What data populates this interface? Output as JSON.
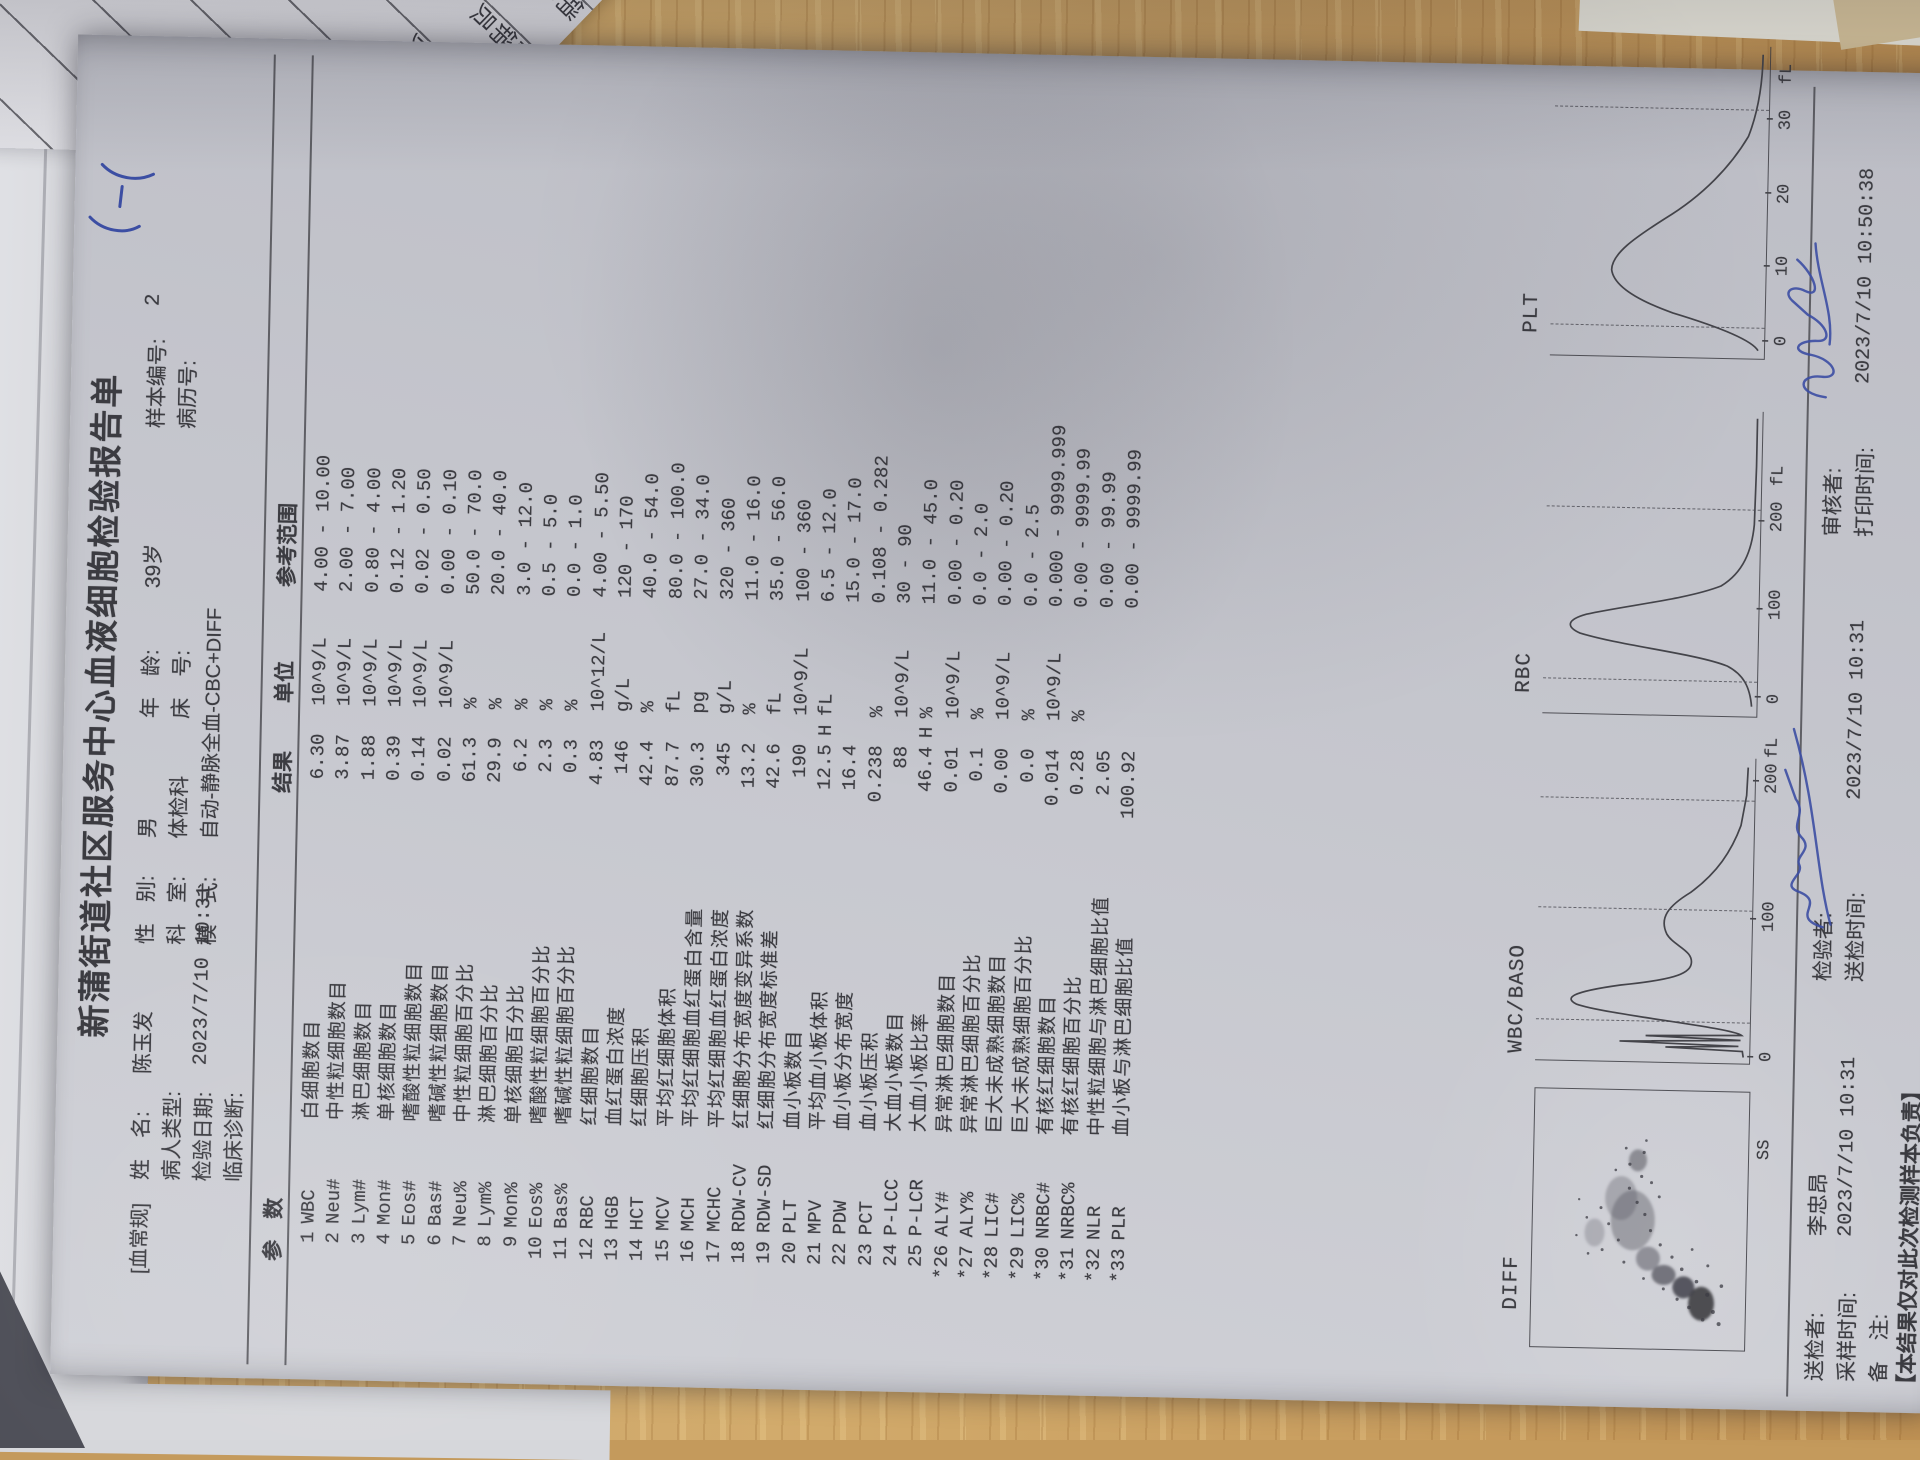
{
  "desk_papers": {
    "cells": [
      "日化促",
      "日化促销",
      "化促销员",
      "促销员",
      "销员",
      "员"
    ],
    "names": [
      "余",
      "张华",
      "鲁景玉"
    ]
  },
  "report": {
    "title": "新蒲街道社区服务中心血液细胞检验报告单",
    "category_tag": "[血常规]",
    "handwritten_mark": "5-5",
    "header": {
      "name_label": "姓　名:",
      "name_value": "陈玉发",
      "sex_label": "性　别:",
      "sex_value": "男",
      "age_label": "年　龄:",
      "age_value": "39岁",
      "sample_no_label": "样本编号:",
      "sample_no_value": "2",
      "patient_type_label": "病人类型:",
      "patient_type_value": "",
      "dept_label": "科　室:",
      "dept_value": "体检科",
      "bed_label": "床　号:",
      "bed_value": "",
      "case_no_label": "病历号:",
      "case_no_value": "",
      "test_date_label": "检验日期:",
      "test_date_value": "2023/7/10  10:31",
      "mode_label": "模　式:",
      "mode_value": "自动-静脉全血-CBC+DIFF",
      "diagnosis_label": "临床诊断:",
      "diagnosis_value": ""
    },
    "table": {
      "headers": {
        "param": "参　数",
        "result": "结果",
        "unit": "单位",
        "range": "参考范围"
      },
      "rows": [
        {
          "num": "1",
          "code": "WBC",
          "name": "白细胞数目",
          "result": "6.30",
          "flag": "",
          "unit": "10^9/L",
          "range": "4.00 - 10.00"
        },
        {
          "num": "2",
          "code": "Neu#",
          "name": "中性粒细胞数目",
          "result": "3.87",
          "flag": "",
          "unit": "10^9/L",
          "range": "2.00 - 7.00"
        },
        {
          "num": "3",
          "code": "Lym#",
          "name": "淋巴细胞数目",
          "result": "1.88",
          "flag": "",
          "unit": "10^9/L",
          "range": "0.80 - 4.00"
        },
        {
          "num": "4",
          "code": "Mon#",
          "name": "单核细胞数目",
          "result": "0.39",
          "flag": "",
          "unit": "10^9/L",
          "range": "0.12 - 1.20"
        },
        {
          "num": "5",
          "code": "Eos#",
          "name": "嗜酸性粒细胞数目",
          "result": "0.14",
          "flag": "",
          "unit": "10^9/L",
          "range": "0.02 - 0.50"
        },
        {
          "num": "6",
          "code": "Bas#",
          "name": "嗜碱性粒细胞数目",
          "result": "0.02",
          "flag": "",
          "unit": "10^9/L",
          "range": "0.00 - 0.10"
        },
        {
          "num": "7",
          "code": "Neu%",
          "name": "中性粒细胞百分比",
          "result": "61.3",
          "flag": "",
          "unit": "%",
          "range": "50.0 - 70.0"
        },
        {
          "num": "8",
          "code": "Lym%",
          "name": "淋巴细胞百分比",
          "result": "29.9",
          "flag": "",
          "unit": "%",
          "range": "20.0 - 40.0"
        },
        {
          "num": "9",
          "code": "Mon%",
          "name": "单核细胞百分比",
          "result": "6.2",
          "flag": "",
          "unit": "%",
          "range": "3.0 - 12.0"
        },
        {
          "num": "10",
          "code": "Eos%",
          "name": "嗜酸性粒细胞百分比",
          "result": "2.3",
          "flag": "",
          "unit": "%",
          "range": "0.5 - 5.0"
        },
        {
          "num": "11",
          "code": "Bas%",
          "name": "嗜碱性粒细胞百分比",
          "result": "0.3",
          "flag": "",
          "unit": "%",
          "range": "0.0 - 1.0"
        },
        {
          "num": "12",
          "code": "RBC",
          "name": "红细胞数目",
          "result": "4.83",
          "flag": "",
          "unit": "10^12/L",
          "range": "4.00 - 5.50"
        },
        {
          "num": "13",
          "code": "HGB",
          "name": "血红蛋白浓度",
          "result": "146",
          "flag": "",
          "unit": "g/L",
          "range": "120 - 170"
        },
        {
          "num": "14",
          "code": "HCT",
          "name": "红细胞压积",
          "result": "42.4",
          "flag": "",
          "unit": "%",
          "range": "40.0 - 54.0"
        },
        {
          "num": "15",
          "code": "MCV",
          "name": "平均红细胞体积",
          "result": "87.7",
          "flag": "",
          "unit": "fL",
          "range": "80.0 - 100.0"
        },
        {
          "num": "16",
          "code": "MCH",
          "name": "平均红细胞血红蛋白含量",
          "result": "30.3",
          "flag": "",
          "unit": "pg",
          "range": "27.0 - 34.0"
        },
        {
          "num": "17",
          "code": "MCHC",
          "name": "平均红细胞血红蛋白浓度",
          "result": "345",
          "flag": "",
          "unit": "g/L",
          "range": "320 - 360"
        },
        {
          "num": "18",
          "code": "RDW-CV",
          "name": "红细胞分布宽度变异系数",
          "result": "13.2",
          "flag": "",
          "unit": "%",
          "range": "11.0 - 16.0"
        },
        {
          "num": "19",
          "code": "RDW-SD",
          "name": "红细胞分布宽度标准差",
          "result": "42.6",
          "flag": "",
          "unit": "fL",
          "range": "35.0 - 56.0"
        },
        {
          "num": "20",
          "code": "PLT",
          "name": "血小板数目",
          "result": "190",
          "flag": "",
          "unit": "10^9/L",
          "range": "100 - 360"
        },
        {
          "num": "21",
          "code": "MPV",
          "name": "平均血小板体积",
          "result": "12.5",
          "flag": "H",
          "unit": "fL",
          "range": "6.5 - 12.0"
        },
        {
          "num": "22",
          "code": "PDW",
          "name": "血小板分布宽度",
          "result": "16.4",
          "flag": "",
          "unit": "",
          "range": "15.0 - 17.0"
        },
        {
          "num": "23",
          "code": "PCT",
          "name": "血小板压积",
          "result": "0.238",
          "flag": "",
          "unit": "%",
          "range": "0.108 - 0.282"
        },
        {
          "num": "24",
          "code": "P-LCC",
          "name": "大血小板数目",
          "result": "88",
          "flag": "",
          "unit": "10^9/L",
          "range": "30 - 90"
        },
        {
          "num": "25",
          "code": "P-LCR",
          "name": "大血小板比率",
          "result": "46.4",
          "flag": "H",
          "unit": "%",
          "range": "11.0 - 45.0"
        },
        {
          "num": "*26",
          "code": "ALY#",
          "name": "异常淋巴细胞数目",
          "result": "0.01",
          "flag": "",
          "unit": "10^9/L",
          "range": "0.00 - 0.20"
        },
        {
          "num": "*27",
          "code": "ALY%",
          "name": "异常淋巴细胞百分比",
          "result": "0.1",
          "flag": "",
          "unit": "%",
          "range": "0.0 - 2.0"
        },
        {
          "num": "*28",
          "code": "LIC#",
          "name": "巨大未成熟细胞数目",
          "result": "0.00",
          "flag": "",
          "unit": "10^9/L",
          "range": "0.00 - 0.20"
        },
        {
          "num": "*29",
          "code": "LIC%",
          "name": "巨大未成熟细胞百分比",
          "result": "0.0",
          "flag": "",
          "unit": "%",
          "range": "0.0 - 2.5"
        },
        {
          "num": "*30",
          "code": "NRBC#",
          "name": "有核红细胞数目",
          "result": "0.014",
          "flag": "",
          "unit": "10^9/L",
          "range": "0.000 - 9999.999"
        },
        {
          "num": "*31",
          "code": "NRBC%",
          "name": "有核红细胞百分比",
          "result": "0.28",
          "flag": "",
          "unit": "%",
          "range": "0.00 - 9999.99"
        },
        {
          "num": "*32",
          "code": "NLR",
          "name": "中性粒细胞与淋巴细胞比值",
          "result": "2.05",
          "flag": "",
          "unit": "",
          "range": "0.00 - 99.99"
        },
        {
          "num": "*33",
          "code": "PLR",
          "name": "血小板与淋巴细胞比值",
          "result": "100.92",
          "flag": "",
          "unit": "",
          "range": "0.00 - 9999.99"
        }
      ]
    },
    "graphs": [
      {
        "label": "DIFF",
        "x_axis_label": "SS"
      },
      {
        "label": "WBC/BASO",
        "ticks": [
          "0",
          "100",
          "200"
        ],
        "unit": "fL"
      },
      {
        "label": "RBC",
        "ticks": [
          "0",
          "100",
          "200"
        ],
        "unit": "fL"
      },
      {
        "label": "PLT",
        "ticks": [
          "0",
          "10",
          "20",
          "30"
        ],
        "unit": "fL"
      }
    ],
    "footer": {
      "sender_label": "送检者:",
      "sender_value": "李忠昂",
      "tester_label": "检验者:",
      "reviewer_label": "审核者:",
      "sample_time_label": "采样时间:",
      "sample_time_value": "2023/7/10  10:31",
      "send_time_label": "送检时间:",
      "send_time_value": "2023/7/10  10:31",
      "print_time_label": "打印时间:",
      "print_time_value": "2023/7/10  10:50:38",
      "note_label": "备　注:",
      "disclaimer": "【本结果仅对此次检测样本负责】"
    }
  }
}
